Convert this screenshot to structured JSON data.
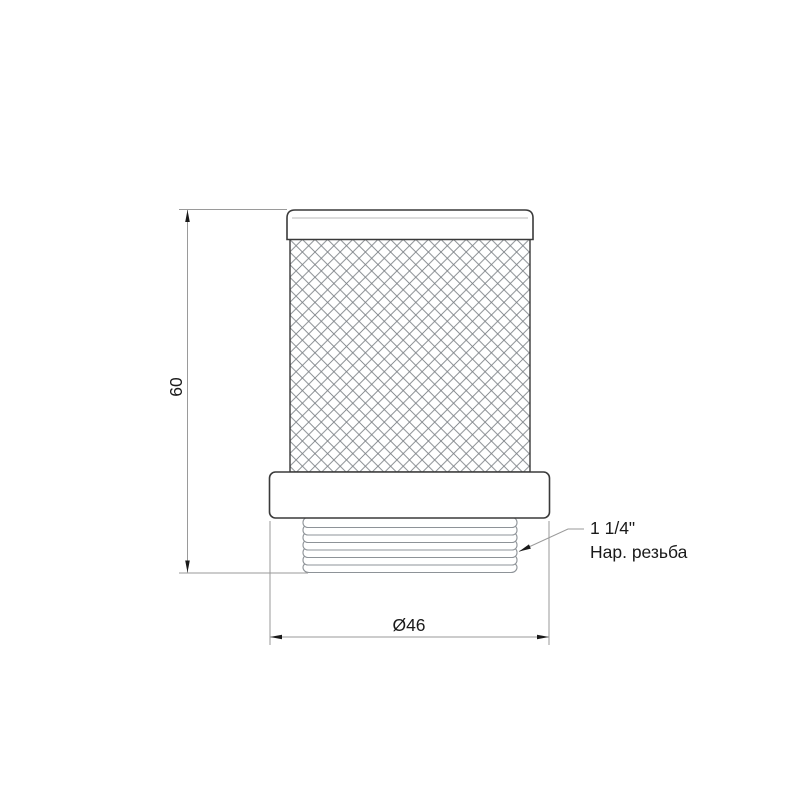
{
  "drawing": {
    "type": "technical-drawing-mesh-strainer"
  },
  "labels": {
    "height": "60",
    "diameter": "Ø46"
  },
  "annotation": {
    "line1": "1 1/4\"",
    "line2": "Нар. резьба"
  },
  "colors": {
    "background": "#ffffff",
    "outline": "#3a3a3a",
    "thread": "#8e9398",
    "mesh": "#7d8287",
    "dimension": "#9a9a9a",
    "arrow": "#1a1a1a",
    "text": "#1a1a1a"
  }
}
